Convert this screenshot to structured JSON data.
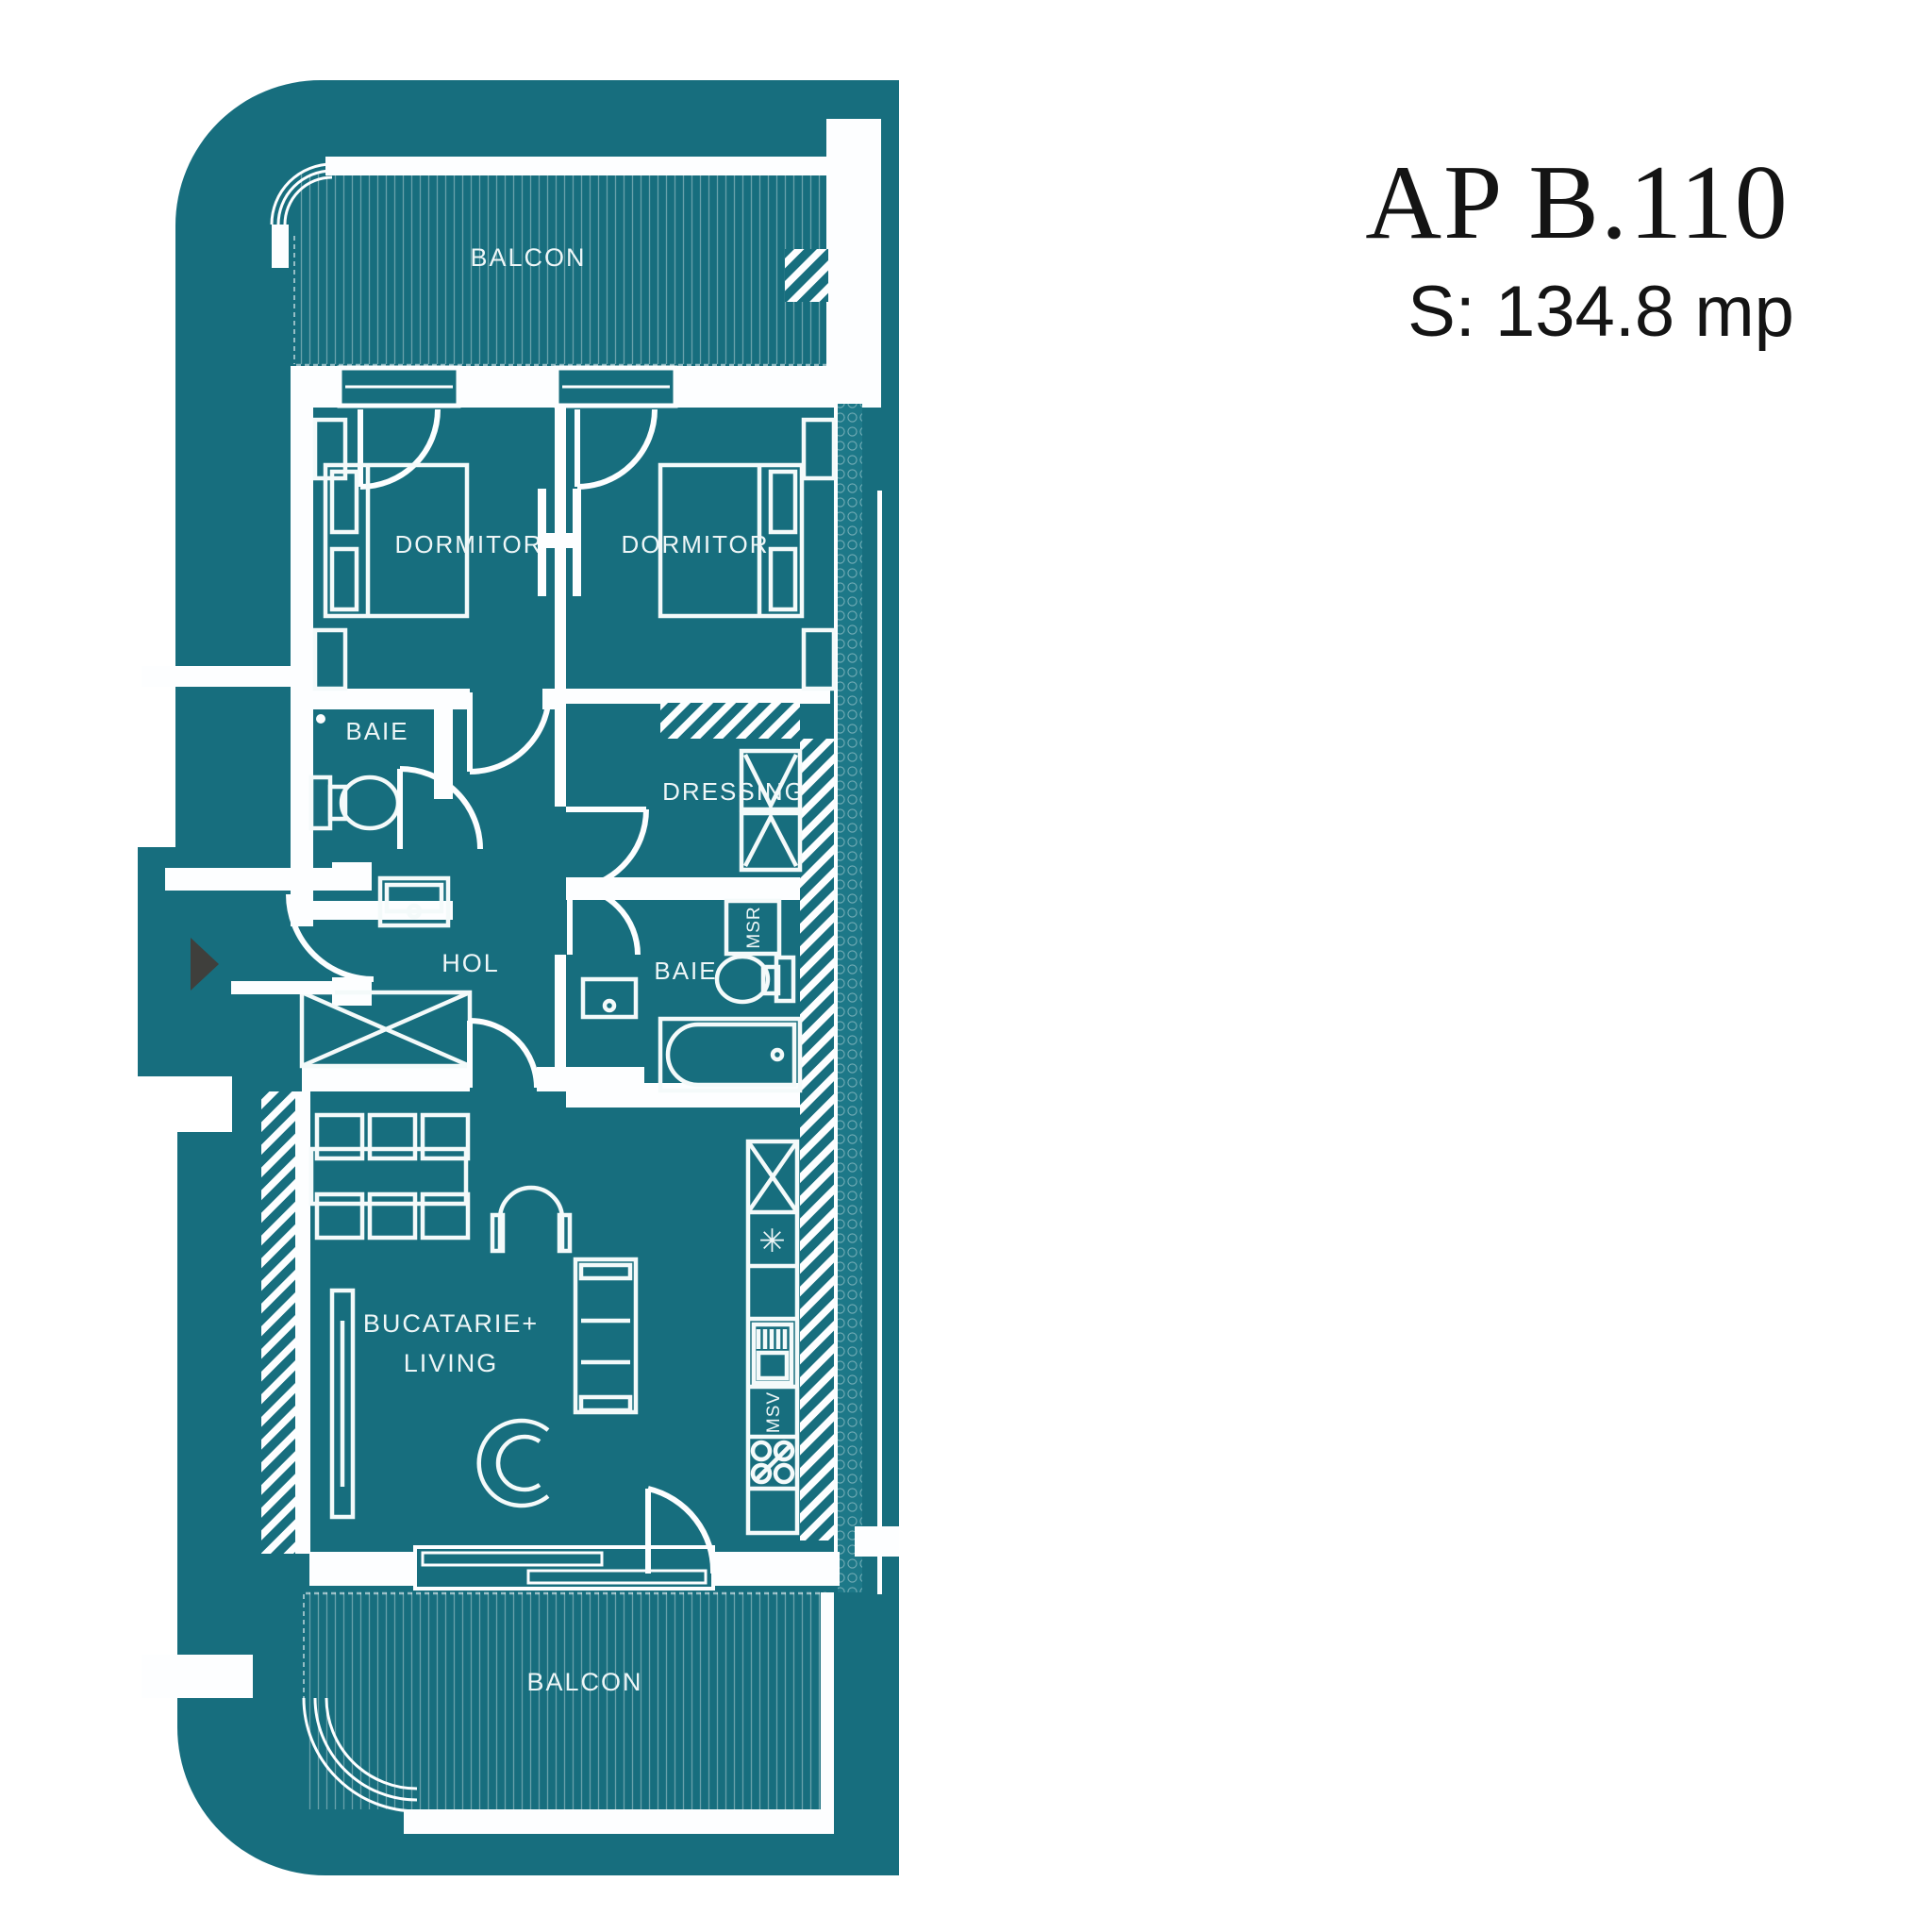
{
  "header": {
    "apartment_code": "AP B.110",
    "area_label": "S: 134.8 mp"
  },
  "plan": {
    "balcony_top": "BALCON",
    "balcony_bottom": "BALCON",
    "bedroom_left": "DORMITOR",
    "bedroom_right": "DORMITOR",
    "bathroom_top": "BAIE",
    "bathroom_main": "BAIE",
    "dressing": "DRESSING",
    "hallway": "HOL",
    "kitchen_living_1": "BUCATARIE+",
    "kitchen_living_2": "LIVING",
    "washing_machine": "MSR",
    "dishwasher": "MSV",
    "cooktop_symbol": "✳"
  },
  "colors": {
    "plan_fill": "#176e7e",
    "line_white": "#fdfeff",
    "background": "#ffffff",
    "entry_arrow": "#3f3f3c",
    "title_text": "#141414"
  }
}
